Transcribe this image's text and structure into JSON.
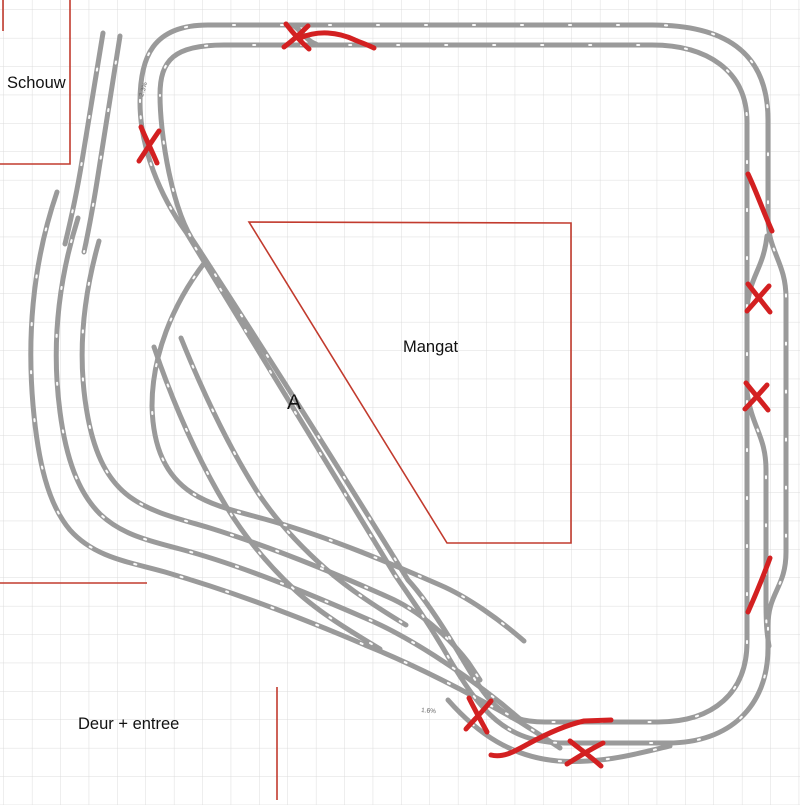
{
  "labels": {
    "schouw": "Schouw",
    "mangat": "Mangat",
    "section_a": "A",
    "deur_entree": "Deur + entree"
  },
  "grade_labels": {
    "grade_top_left": "2.3%",
    "grade_bottom_center": "1.6%"
  },
  "colors": {
    "background": "#ffffff",
    "grid": "#dcdcdc",
    "track": "#9a9a9a",
    "track_joint": "#ffffff",
    "boundary": "#c23b2e",
    "annotation": "#d32021",
    "label": "#111111",
    "grade": "#666666"
  }
}
